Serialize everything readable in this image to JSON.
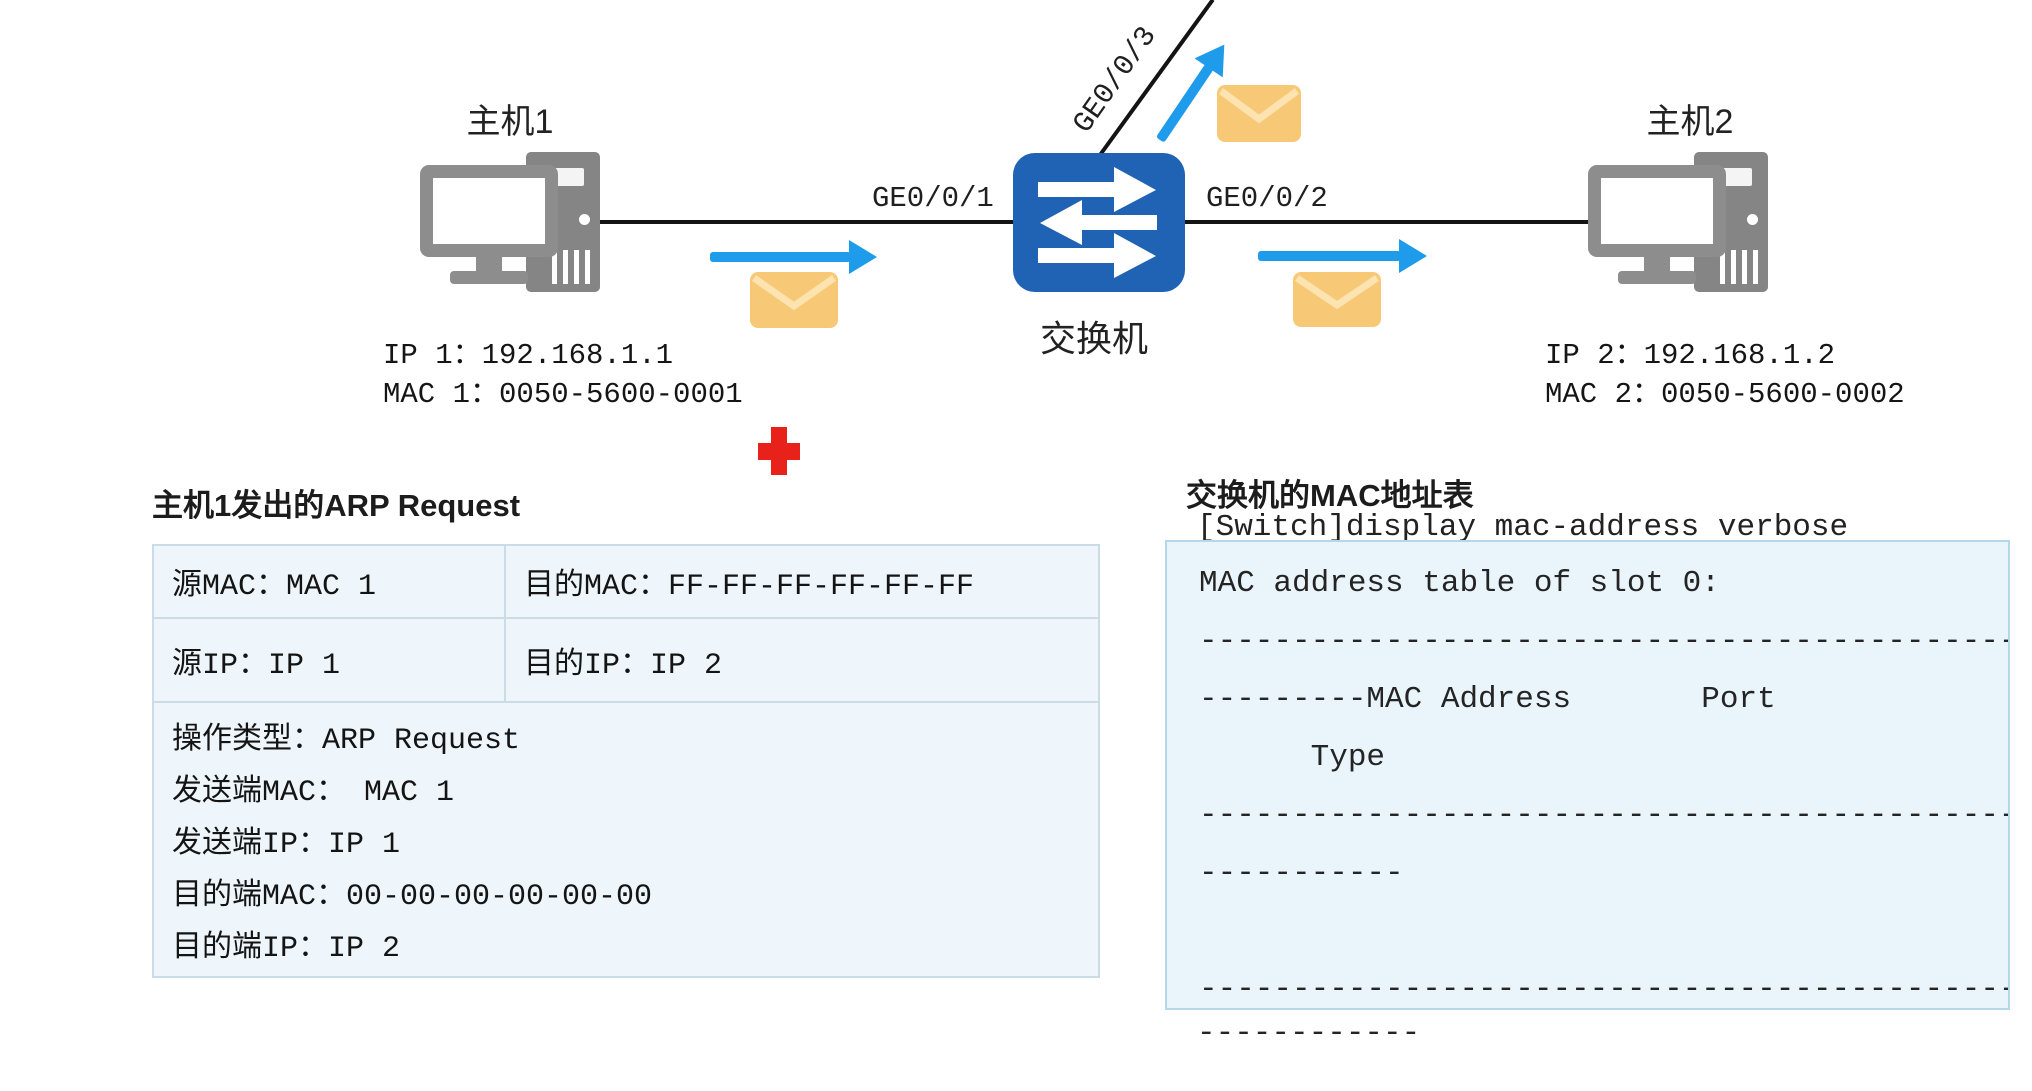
{
  "diagram": {
    "host1": {
      "label": "主机1",
      "ip": "IP 1：192.168.1.1",
      "mac": "MAC 1：0050-5600-0001"
    },
    "host2": {
      "label": "主机2",
      "ip": "IP 2：192.168.1.2",
      "mac": "MAC 2：0050-5600-0002"
    },
    "switch": {
      "label": "交换机"
    },
    "ports": {
      "ge1": "GE0/0/1",
      "ge2": "GE0/0/2",
      "ge3": "GE0/0/3"
    }
  },
  "arp_request": {
    "title": "主机1发出的ARP Request",
    "src_mac": "源MAC：MAC 1",
    "dst_mac": "目的MAC：FF-FF-FF-FF-FF-FF",
    "src_ip": "源IP：IP 1",
    "dst_ip": "目的IP：IP 2",
    "details": [
      "操作类型：ARP Request",
      "发送端MAC： MAC 1",
      "发送端IP：IP 1",
      "目的端MAC：00-00-00-00-00-00",
      "目的端IP：IP 2"
    ]
  },
  "mac_table": {
    "title": "交换机的MAC地址表",
    "command": "[Switch]display mac-address verbose",
    "terminal_lines": [
      "MAC address table of slot 0:",
      "--------------------------------------------",
      "---------MAC Address       Port",
      "      Type",
      "--------------------------------------------",
      "-----------",
      " ",
      "--------------------------------------------"
    ],
    "overflow_dashes": "------------"
  },
  "appearance": {
    "switch_blue": "#2062b4",
    "arrow_blue": "#1e9bea",
    "envelope_yellow": "#f7c977",
    "cross_red": "#e8221a",
    "table_bg": "#eef6fb",
    "terminal_bg": "#e9f4fb"
  },
  "icons": {
    "host": "desktop-computer-icon",
    "switch": "switch-arrows-icon",
    "packet": "envelope-icon",
    "marker": "red-cross-icon"
  }
}
